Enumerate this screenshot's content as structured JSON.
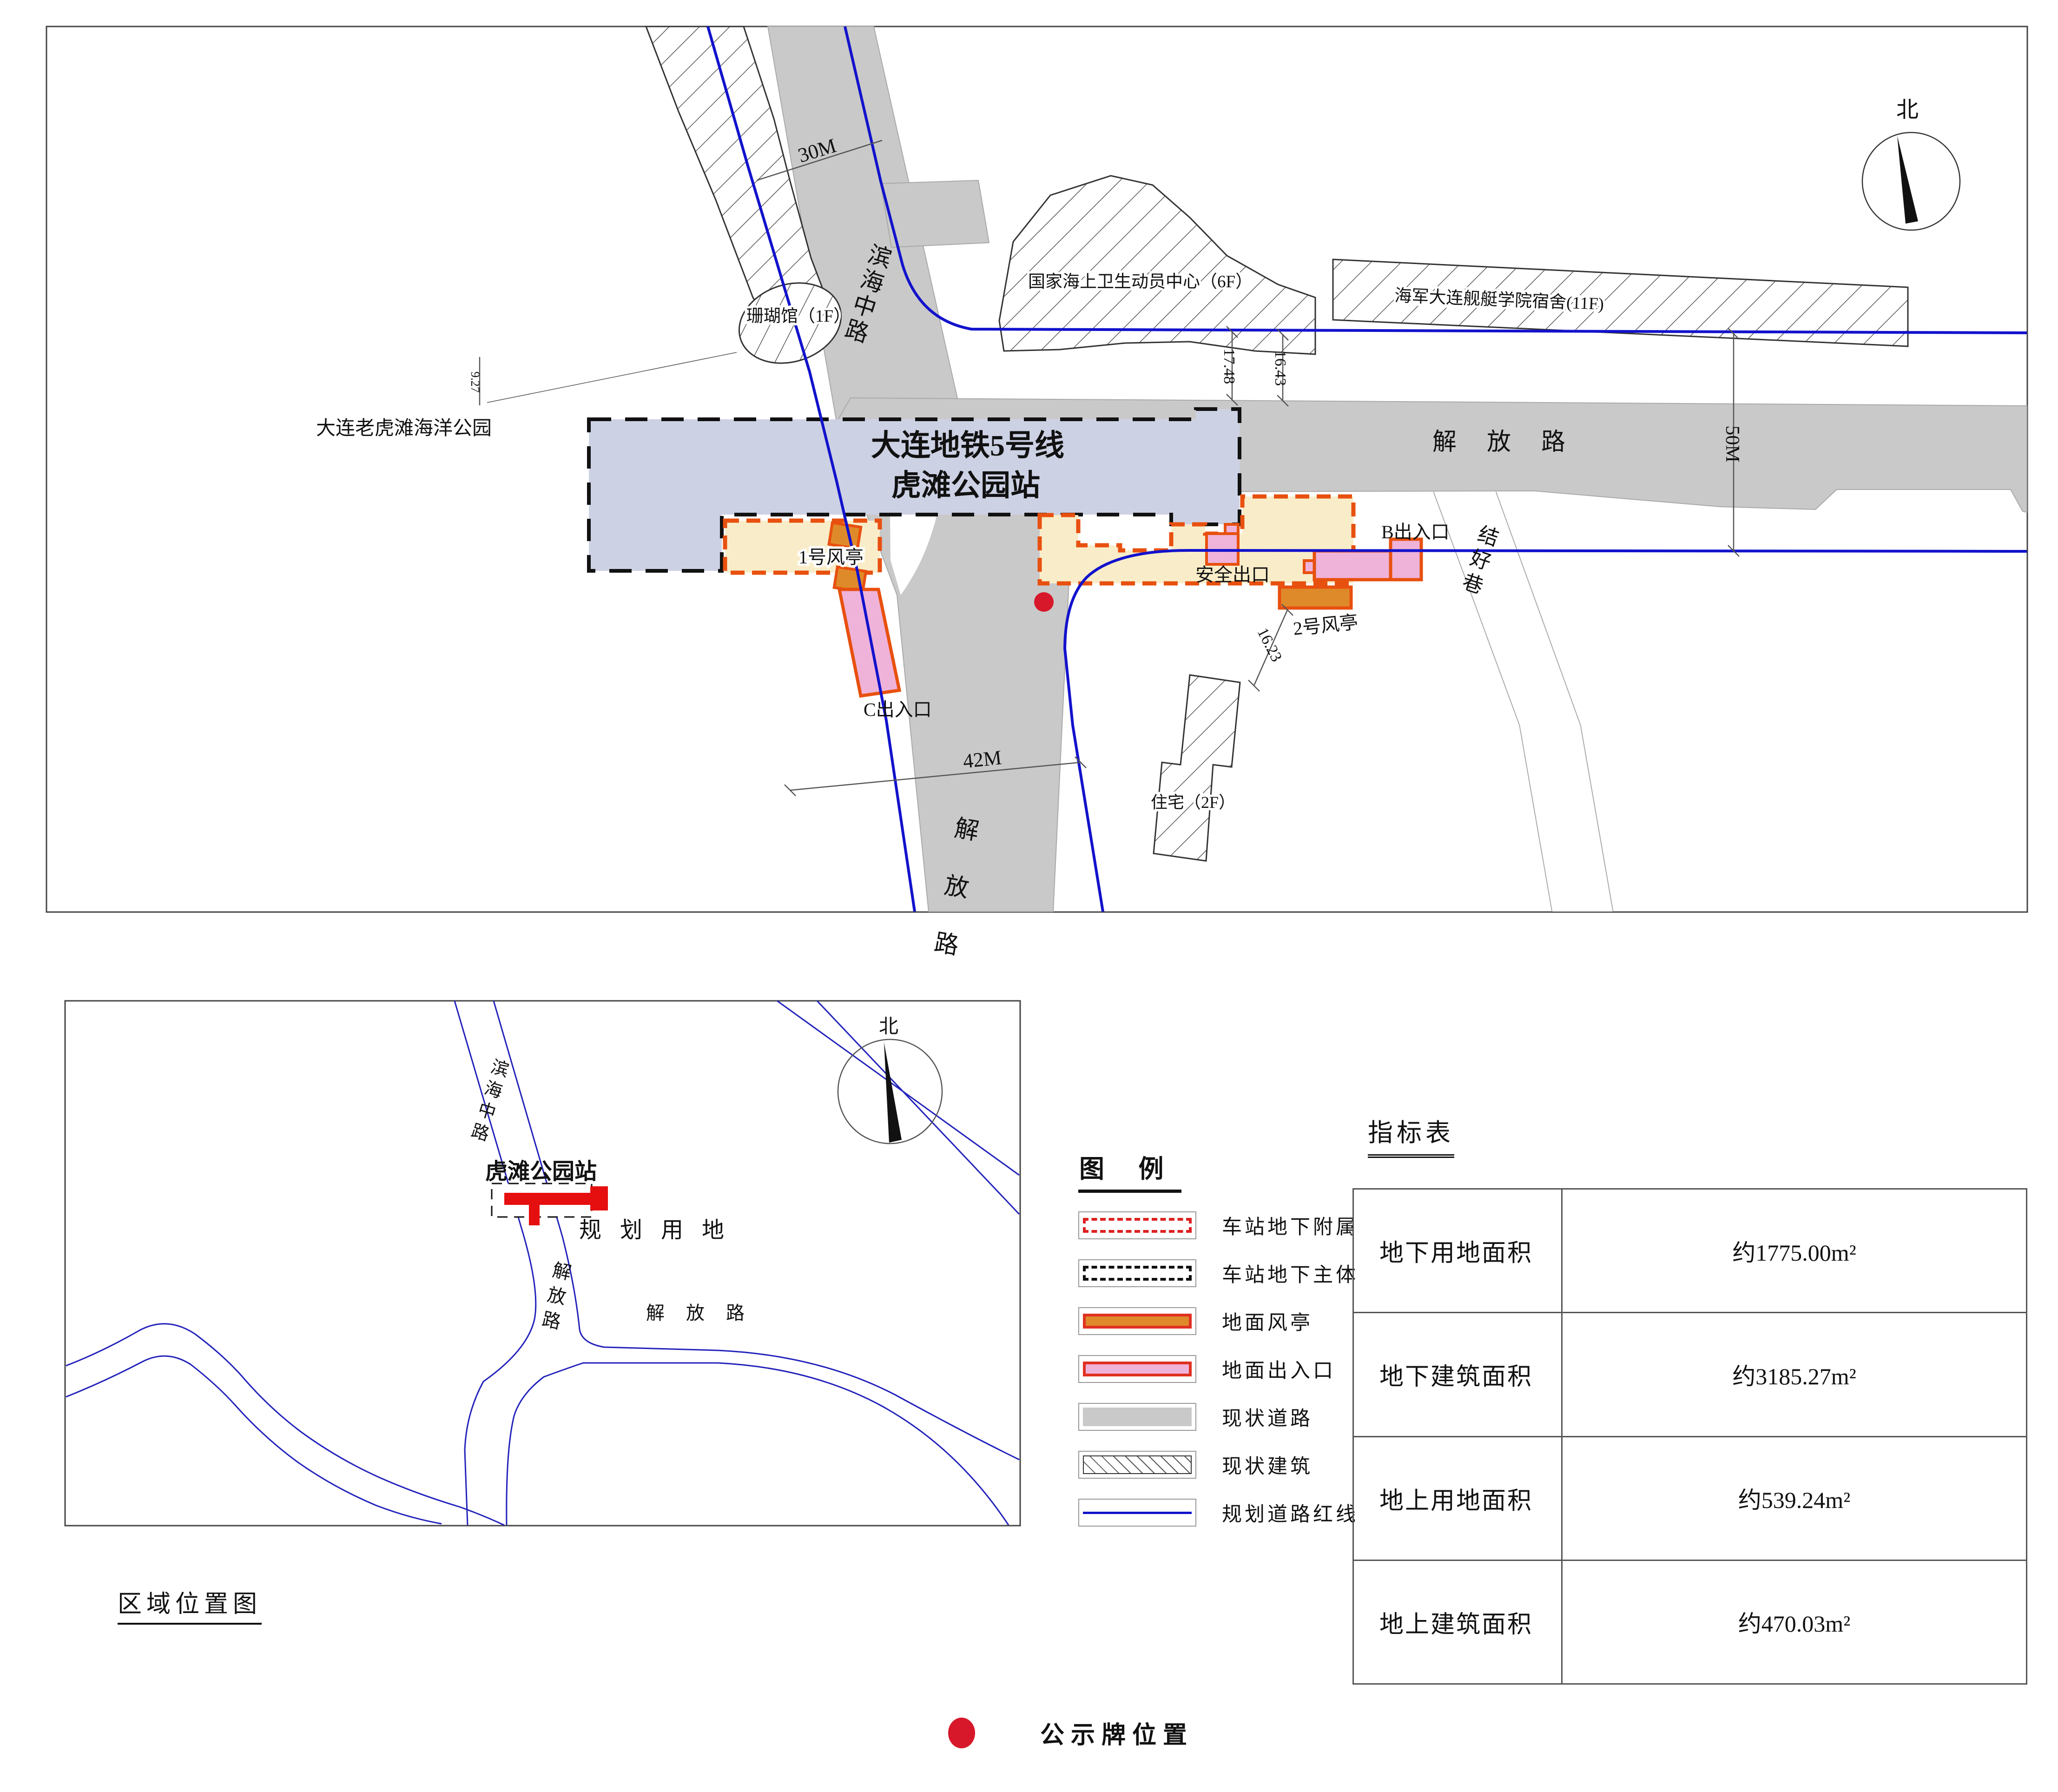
{
  "colors": {
    "station_fill": "#cdd1e4",
    "attachment_fill": "#f9edc9",
    "vent_fill": "#df8a2a",
    "exit_fill": "#efb3da",
    "attachment_border": "#e8500f",
    "legend_red": "#dd2020",
    "road_gray": "#c9c9c9",
    "redline_blue": "#1212cc",
    "notice_red": "#d7182a",
    "hatch_line": "#555555"
  },
  "main_map": {
    "station_line1": "大连地铁5号线",
    "station_line2": "虎滩公园站",
    "park": "大连老虎滩海洋公园",
    "road_binhai": "滨海中路",
    "road_jiefang_east": "解 放 路",
    "road_jiefang_south": "解 放 路",
    "road_jiehao": "结好巷",
    "bldg_coral": "珊瑚馆（1F）",
    "bldg_health": "国家海上卫生动员中心（6F）",
    "bldg_navy": "海军大连舰艇学院宿舍(11F)",
    "bldg_residence": "住宅（2F）",
    "vent1": "1号风亭",
    "vent2": "2号风亭",
    "exit_b": "B出入口",
    "exit_c": "C出入口",
    "safe_exit": "安全出口",
    "north": "北",
    "dim_30m": "30M",
    "dim_42m": "42M",
    "dim_50m": "50M",
    "dim_927": "9.27",
    "dim_1748": "17.48",
    "dim_1643": "16.43",
    "dim_1623": "16.23"
  },
  "region_map": {
    "title": "区域位置图",
    "station": "虎滩公园站",
    "planning": "规 划 用 地",
    "road_jiefang_east": "解 放 路",
    "road_jiefang_south": "解放路",
    "road_binhai": "滨海中路",
    "north": "北"
  },
  "legend": {
    "title": "图  例",
    "items": [
      {
        "label": "车站地下附属"
      },
      {
        "label": "车站地下主体"
      },
      {
        "label": "地面风亭"
      },
      {
        "label": "地面出入口"
      },
      {
        "label": "现状道路"
      },
      {
        "label": "现状建筑"
      },
      {
        "label": "规划道路红线"
      }
    ]
  },
  "table": {
    "title": "指标表",
    "rows": [
      {
        "label": "地下用地面积",
        "value": "约1775.00m²"
      },
      {
        "label": "地下建筑面积",
        "value": "约3185.27m²"
      },
      {
        "label": "地上用地面积",
        "value": "约539.24m²"
      },
      {
        "label": "地上建筑面积",
        "value": "约470.03m²"
      }
    ]
  },
  "notice": {
    "label": "公示牌位置"
  }
}
